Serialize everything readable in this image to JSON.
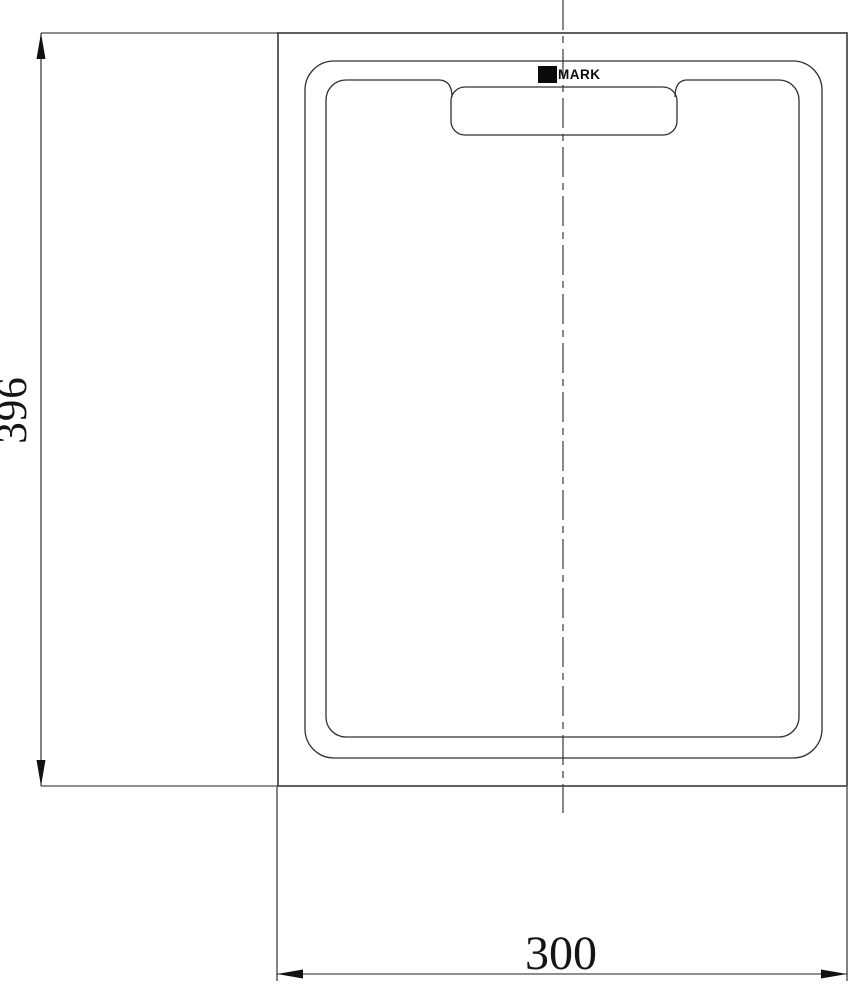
{
  "drawing": {
    "type": "technical-drawing-top-view-cutting-board",
    "brand_label": "MARK",
    "dimensions": {
      "height": "396",
      "width": "300"
    },
    "colors": {
      "background": "#ffffff",
      "outline": "#303030",
      "frame_line": "#4f4f4f",
      "dimension_line": "#1c1c1c",
      "centerline": "#474747",
      "logo": "#0a0a0a"
    }
  }
}
